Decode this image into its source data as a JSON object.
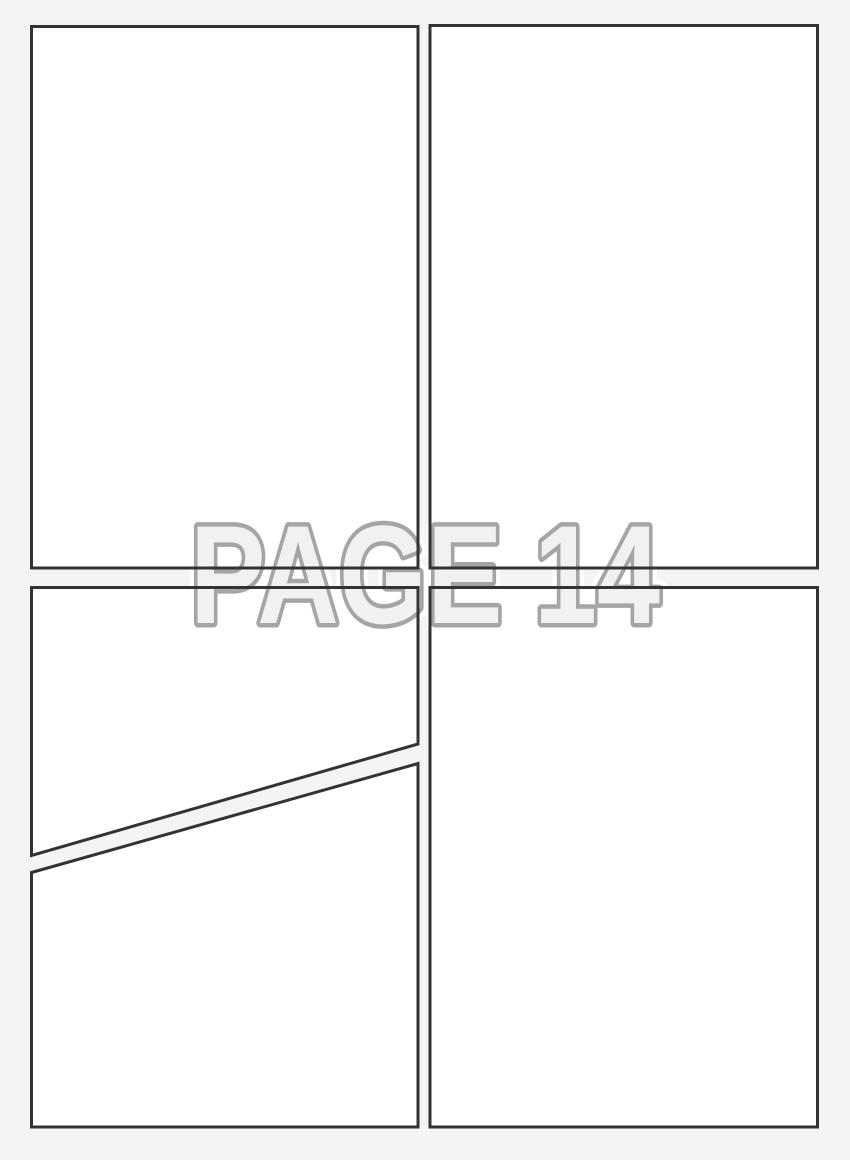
{
  "page": {
    "title": "Blank comic page template",
    "watermark": {
      "text": "PAGE 14"
    },
    "panel_count": 5
  },
  "colors": {
    "page_bg": "#f4f4f5",
    "panel_fill": "#ffffff",
    "panel_border": "#333333",
    "watermark_fill": "#f1f1f2",
    "watermark_outline": "#a5a5a5",
    "watermark_halo": "#ffffff"
  }
}
